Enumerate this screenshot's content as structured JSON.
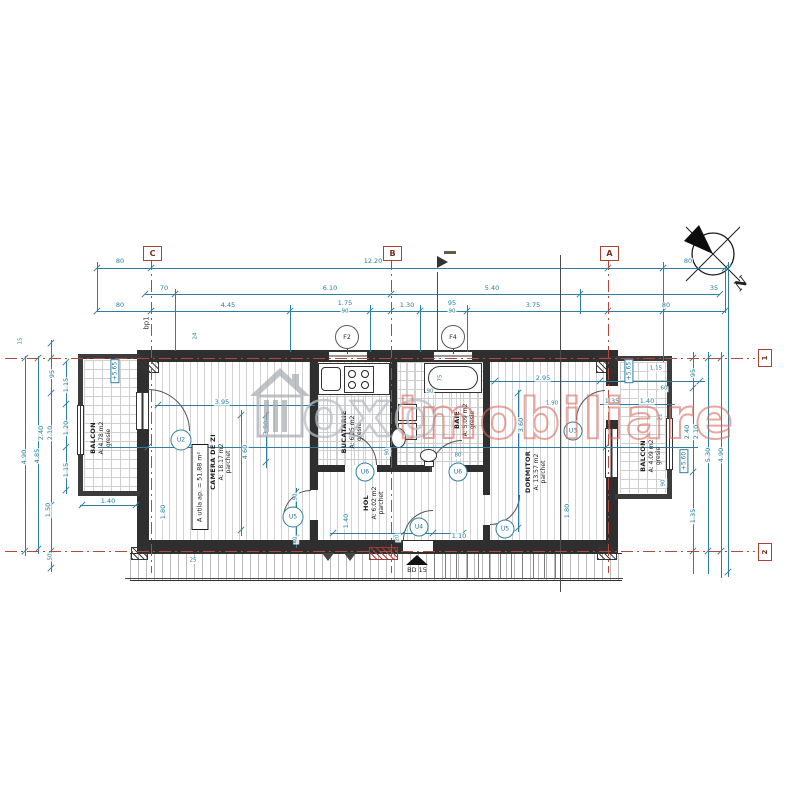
{
  "watermark": {
    "text_gray": "oxo",
    "text_red": "imobiliare",
    "logo": "house-icon"
  },
  "compass": {
    "label": "N"
  },
  "grid": {
    "top": [
      {
        "label": "C"
      },
      {
        "label": "B"
      },
      {
        "label": "A"
      }
    ],
    "right": [
      {
        "label": "1"
      },
      {
        "label": "2"
      }
    ]
  },
  "rooms": [
    {
      "name": "BALCON",
      "area": "A: 4.78 m2",
      "finish": "gresie"
    },
    {
      "name": "CAMERA DE ZI",
      "area": "A: 18.17 m2",
      "finish": "parchet"
    },
    {
      "name": "BUCATARIE",
      "area": "A: 6.25 m2",
      "finish": "gresie"
    },
    {
      "name": "HOL",
      "area": "A: 6.02 m2",
      "finish": "parchet"
    },
    {
      "name": "BAIE",
      "area": "A: 5.09 m2",
      "finish": "gresie"
    },
    {
      "name": "DORMITOR",
      "area": "A: 13.57 m2",
      "finish": "parchet"
    },
    {
      "name": "BALCON",
      "area": "A: 4.09 m2",
      "finish": "gresie"
    }
  ],
  "apartment_area_label": "A utila ap. = 51.88 m²",
  "entrance_label": "BD 15",
  "foundation_label": "bp1",
  "levels": [
    {
      "t": "+5.65",
      "x": 115,
      "y": 371
    },
    {
      "t": "+5.65",
      "x": 629,
      "y": 371
    },
    {
      "t": "+5.60",
      "x": 684,
      "y": 461
    }
  ],
  "openings": [
    {
      "id": "F2",
      "x": 347,
      "y": 337,
      "d": 22,
      "f": 1
    },
    {
      "id": "F4",
      "x": 453,
      "y": 337,
      "d": 22,
      "f": 1
    },
    {
      "id": "U2",
      "x": 181,
      "y": 440,
      "d": 19
    },
    {
      "id": "U5",
      "x": 293,
      "y": 517,
      "d": 19
    },
    {
      "id": "U6",
      "x": 365,
      "y": 472,
      "d": 17
    },
    {
      "id": "U6",
      "x": 458,
      "y": 472,
      "d": 17
    },
    {
      "id": "U4",
      "x": 419,
      "y": 527,
      "d": 17
    },
    {
      "id": "U5",
      "x": 505,
      "y": 529,
      "d": 17
    },
    {
      "id": "U3",
      "x": 573,
      "y": 431,
      "d": 17
    }
  ],
  "dim_labels": [
    {
      "t": "80",
      "x": 120,
      "y": 261
    },
    {
      "t": "12.20",
      "x": 373,
      "y": 261
    },
    {
      "t": "80",
      "x": 688,
      "y": 261
    },
    {
      "t": "70",
      "x": 164,
      "y": 288
    },
    {
      "t": "6.10",
      "x": 330,
      "y": 288
    },
    {
      "t": "5.40",
      "x": 492,
      "y": 288
    },
    {
      "t": "35",
      "x": 714,
      "y": 288
    },
    {
      "t": "80",
      "x": 120,
      "y": 305
    },
    {
      "t": "4.45",
      "x": 228,
      "y": 305
    },
    {
      "t": "1.75",
      "x": 345,
      "y": 303
    },
    {
      "t": "90",
      "x": 345,
      "y": 312,
      "s": 1
    },
    {
      "t": "1.30",
      "x": 407,
      "y": 305
    },
    {
      "t": "95",
      "x": 452,
      "y": 303
    },
    {
      "t": "90",
      "x": 452,
      "y": 312,
      "s": 1
    },
    {
      "t": "3.75",
      "x": 533,
      "y": 305
    },
    {
      "t": "80",
      "x": 666,
      "y": 305
    },
    {
      "t": "24",
      "x": 196,
      "y": 336,
      "r": -90,
      "s": 1
    },
    {
      "t": "15",
      "x": 21,
      "y": 341,
      "r": -90,
      "s": 1
    },
    {
      "t": "95",
      "x": 52,
      "y": 374,
      "r": -90
    },
    {
      "t": "2.40",
      "x": 41,
      "y": 433,
      "r": -90
    },
    {
      "t": "2.10",
      "x": 50,
      "y": 433,
      "r": -90
    },
    {
      "t": "1.50",
      "x": 48,
      "y": 510,
      "r": -90
    },
    {
      "t": "50",
      "x": 51,
      "y": 557,
      "r": -90,
      "s": 1
    },
    {
      "t": "4.90",
      "x": 24,
      "y": 457,
      "r": -90
    },
    {
      "t": "4.85",
      "x": 37,
      "y": 456,
      "r": -90
    },
    {
      "t": "1.15",
      "x": 66,
      "y": 385,
      "r": -90
    },
    {
      "t": "1.20",
      "x": 66,
      "y": 428,
      "r": -90
    },
    {
      "t": "1.15",
      "x": 66,
      "y": 470,
      "r": -90
    },
    {
      "t": "1.40",
      "x": 108,
      "y": 501
    },
    {
      "t": "25",
      "x": 193,
      "y": 561,
      "s": 1
    },
    {
      "t": "95",
      "x": 693,
      "y": 373,
      "r": -90
    },
    {
      "t": "2.40",
      "x": 687,
      "y": 432,
      "r": -90
    },
    {
      "t": "2.10",
      "x": 696,
      "y": 432,
      "r": -90
    },
    {
      "t": "1.35",
      "x": 693,
      "y": 516,
      "r": -90
    },
    {
      "t": "5.30",
      "x": 708,
      "y": 455,
      "r": -90
    },
    {
      "t": "4.90",
      "x": 721,
      "y": 455,
      "r": -90
    },
    {
      "t": "1.35",
      "x": 612,
      "y": 401
    },
    {
      "t": "1.40",
      "x": 647,
      "y": 401
    },
    {
      "t": "60",
      "x": 664,
      "y": 389,
      "s": 1
    },
    {
      "t": "21",
      "x": 661,
      "y": 417,
      "r": -90,
      "s": 1
    },
    {
      "t": "90",
      "x": 664,
      "y": 483,
      "r": -90,
      "s": 1
    },
    {
      "t": "1.15",
      "x": 656,
      "y": 369,
      "s": 1
    },
    {
      "t": "3.95",
      "x": 222,
      "y": 402
    },
    {
      "t": "4.60",
      "x": 245,
      "y": 452,
      "r": -90
    },
    {
      "t": "3.50",
      "x": 266,
      "y": 428,
      "r": -90
    },
    {
      "t": "2.10",
      "x": 290,
      "y": 516,
      "r": -90
    },
    {
      "t": "90",
      "x": 296,
      "y": 497,
      "r": -90,
      "s": 1
    },
    {
      "t": "40",
      "x": 296,
      "y": 540,
      "r": -90,
      "s": 1
    },
    {
      "t": "1.80",
      "x": 163,
      "y": 512,
      "r": -90
    },
    {
      "t": "90",
      "x": 388,
      "y": 452,
      "r": -90,
      "s": 1
    },
    {
      "t": "1.40",
      "x": 346,
      "y": 521,
      "r": -90
    },
    {
      "t": "1.10",
      "x": 459,
      "y": 536
    },
    {
      "t": "20",
      "x": 398,
      "y": 538,
      "r": -90,
      "s": 1
    },
    {
      "t": "75",
      "x": 441,
      "y": 378,
      "r": -90,
      "s": 1
    },
    {
      "t": "80",
      "x": 458,
      "y": 456,
      "s": 1
    },
    {
      "t": "90",
      "x": 430,
      "y": 392,
      "s": 1
    },
    {
      "t": "2.95",
      "x": 543,
      "y": 378
    },
    {
      "t": "3.60",
      "x": 521,
      "y": 425,
      "r": -90
    },
    {
      "t": "1.80",
      "x": 567,
      "y": 511,
      "r": -90
    },
    {
      "t": "1.90",
      "x": 552,
      "y": 404,
      "s": 1
    }
  ],
  "drawing": {
    "h_lines": [
      [
        97,
        268,
        628
      ],
      [
        145,
        294,
        575
      ],
      [
        97,
        311,
        628
      ],
      [
        155,
        405,
        160
      ],
      [
        490,
        381,
        215
      ],
      [
        98,
        447,
        600
      ],
      [
        80,
        505,
        58
      ],
      [
        600,
        404,
        75
      ],
      [
        330,
        533,
        135
      ],
      [
        125,
        578,
        498,
        1
      ]
    ],
    "v_lines": [
      [
        25,
        356,
        200
      ],
      [
        38,
        356,
        198
      ],
      [
        51,
        340,
        232
      ],
      [
        66,
        362,
        132
      ],
      [
        693,
        352,
        222
      ],
      [
        708,
        352,
        222
      ],
      [
        721,
        352,
        226
      ],
      [
        728,
        262,
        315
      ],
      [
        241,
        410,
        126
      ],
      [
        266,
        412,
        56
      ],
      [
        296,
        488,
        60
      ],
      [
        518,
        390,
        142
      ],
      [
        560,
        255,
        337,
        1
      ],
      [
        437,
        272,
        80,
        1
      ],
      [
        347,
        346,
        8,
        1
      ],
      [
        453,
        346,
        8,
        1
      ],
      [
        97,
        262,
        50
      ],
      [
        663,
        262,
        100
      ],
      [
        725,
        268,
        45
      ],
      [
        175,
        289,
        62
      ],
      [
        580,
        289,
        25
      ],
      [
        420,
        305,
        47
      ],
      [
        467,
        305,
        47
      ],
      [
        290,
        305,
        47
      ],
      [
        370,
        305,
        47
      ]
    ],
    "ticks": [
      [
        97,
        268
      ],
      [
        151,
        268
      ],
      [
        608,
        268
      ],
      [
        663,
        268
      ],
      [
        725,
        268
      ],
      [
        145,
        294
      ],
      [
        175,
        294
      ],
      [
        391,
        294
      ],
      [
        580,
        294
      ],
      [
        720,
        294
      ],
      [
        97,
        311
      ],
      [
        151,
        311
      ],
      [
        290,
        311
      ],
      [
        370,
        311
      ],
      [
        391,
        311
      ],
      [
        420,
        311
      ],
      [
        467,
        311
      ],
      [
        608,
        311
      ],
      [
        663,
        311
      ],
      [
        725,
        311
      ],
      [
        25,
        358
      ],
      [
        25,
        551
      ],
      [
        38,
        358
      ],
      [
        38,
        549
      ],
      [
        51,
        343
      ],
      [
        51,
        358
      ],
      [
        51,
        393
      ],
      [
        51,
        505
      ],
      [
        51,
        551
      ],
      [
        51,
        568
      ],
      [
        66,
        362
      ],
      [
        66,
        404
      ],
      [
        66,
        447
      ],
      [
        66,
        490
      ],
      [
        693,
        358
      ],
      [
        693,
        388
      ],
      [
        693,
        472
      ],
      [
        693,
        551
      ],
      [
        708,
        358
      ],
      [
        708,
        551
      ],
      [
        721,
        358
      ],
      [
        721,
        551
      ],
      [
        728,
        268
      ],
      [
        728,
        572
      ],
      [
        158,
        405
      ],
      [
        311,
        405
      ],
      [
        241,
        415
      ],
      [
        241,
        530
      ],
      [
        518,
        393
      ],
      [
        518,
        528
      ],
      [
        495,
        381
      ],
      [
        600,
        381
      ],
      [
        700,
        381
      ],
      [
        148,
        447
      ],
      [
        606,
        447
      ],
      [
        82,
        505
      ],
      [
        136,
        505
      ],
      [
        333,
        533
      ],
      [
        403,
        533
      ],
      [
        433,
        533
      ],
      [
        463,
        533
      ],
      [
        296,
        492
      ],
      [
        296,
        512
      ],
      [
        296,
        538
      ],
      [
        266,
        415
      ],
      [
        266,
        462
      ]
    ],
    "v_axes": [
      [
        151,
        258,
        315
      ],
      [
        391,
        258,
        315
      ],
      [
        608,
        258,
        315
      ]
    ],
    "h_axes": [
      [
        5,
        358,
        750
      ],
      [
        5,
        551,
        750
      ]
    ]
  }
}
